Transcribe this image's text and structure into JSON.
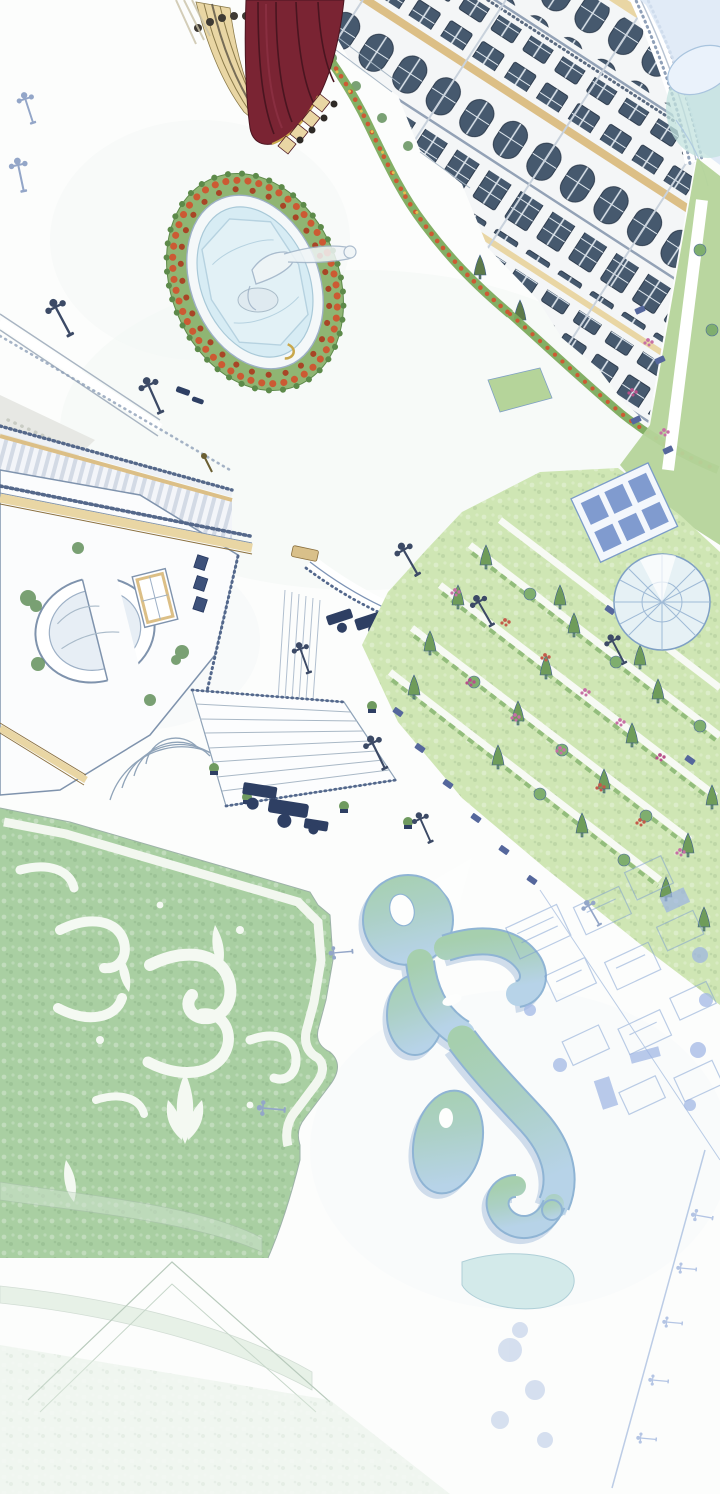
{
  "panel": {
    "kind": "webtoon-aerial-illustration",
    "width": 720,
    "height": 1494,
    "alt": "Hand-drawn bird's-eye view of a palace complex: ornate facade with dark windows, a red mansard roof, an oval fountain ringed by orange flowers, an arched gate pavilion, terraced gardens with cypress rows, a green parterre lawn with white scroll ornament, a curving ornamental pond, and faded blue garden sketches below"
  },
  "scene": {
    "elements": [
      "red-mansard-roof",
      "palace-facade",
      "parapet-balustrade",
      "corner-dome",
      "statue-fountain",
      "flower-hedge-ring",
      "street-lamps",
      "upper-road",
      "cobblestone-path",
      "colonnade",
      "arched-gate-building",
      "curved-ramp",
      "grand-staircase",
      "bench-clusters",
      "terraced-gardens",
      "glass-dome-pavilion",
      "parterre-lawn",
      "scroll-ornaments",
      "ornamental-pond",
      "faded-palace-sketch",
      "avenue-of-lamps",
      "teal-garden-patch",
      "corner-bands"
    ]
  },
  "palette": {
    "paper": "#fcfdfc",
    "maroon": "#7a2433",
    "maroonDark": "#4a1520",
    "cream": "#e9d6a4",
    "tan": "#dcbf86",
    "gold": "#c9a84c",
    "wallWhite": "#f4f6f7",
    "corniceGray": "#93a2b6",
    "lineBlue": "#7f93ad",
    "slateWindow": "#46596e",
    "paleGlass": "#bcd9ea",
    "hedgeGreen": "#7cab5d",
    "hedgeRing": "#8fb573",
    "ivyGreen": "#63905c",
    "treeGreen": "#6f9c5a",
    "lawnLight": "#cfe6b4",
    "lawnStrip": "#b5d49a",
    "parterreGreen": "#a9cfa2",
    "water": "#d7ecf4",
    "pondTop": "#a6cfae",
    "pondBottom": "#b7d3e8",
    "pondEdge": "#8fb4d4",
    "flowerOrange": "#cc5a33",
    "flowerPink": "#c76fa4",
    "flowerYellow": "#e3bf4f",
    "lampDark": "#3c4a66",
    "lampFaded": "#93a6c8",
    "navy": "#2e3f63",
    "stoneGray": "#e7e8e4",
    "domeBlue": "#dce8f6",
    "domeTeal": "#c2e2de",
    "sketchBlue": "#7b9cd0",
    "tealPatch": "#cfe9e9",
    "bandGreen": "#d4e6d4"
  }
}
